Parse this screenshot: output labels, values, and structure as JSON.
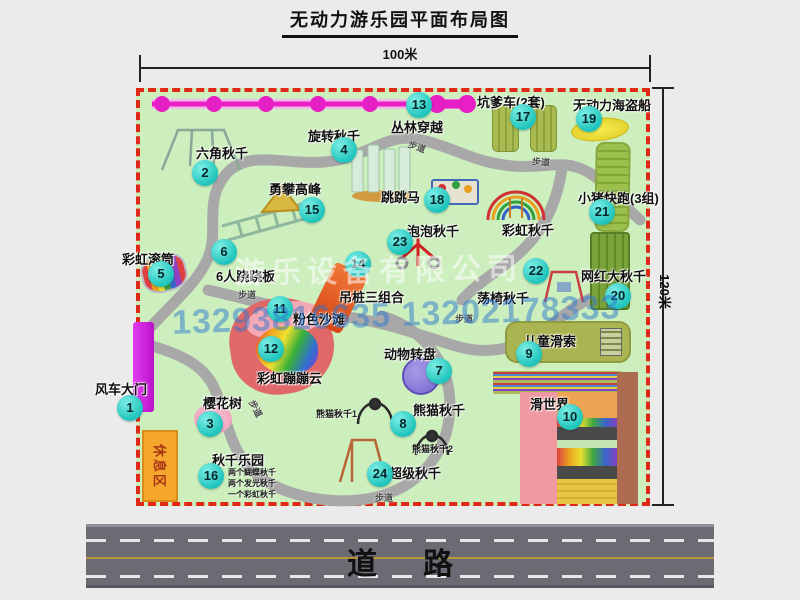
{
  "title": "无动力游乐园平面布局图",
  "dimensions": {
    "width": "100米",
    "height": "120米"
  },
  "road_label": "道路",
  "watermark": {
    "company": "游乐设备有限公司",
    "phones": "13293816635 13202178333"
  },
  "rest_area_label": "休息区",
  "path_label": "步道",
  "attractions": [
    {
      "num": "1",
      "name": "风车大门"
    },
    {
      "num": "2",
      "name": "六角秋千"
    },
    {
      "num": "3",
      "name": "樱花树"
    },
    {
      "num": "4",
      "name": "旋转秋千"
    },
    {
      "num": "5",
      "name": "彩虹滚筒"
    },
    {
      "num": "6",
      "name": "6人跷跷板"
    },
    {
      "num": "7",
      "name": "动物转盘"
    },
    {
      "num": "8",
      "name": "熊猫秋千"
    },
    {
      "num": "9",
      "name": "儿童滑索"
    },
    {
      "num": "10",
      "name": "滑世界"
    },
    {
      "num": "11",
      "name": "粉色沙滩"
    },
    {
      "num": "12",
      "name": "彩虹蹦蹦云"
    },
    {
      "num": "13",
      "name": "丛林穿越"
    },
    {
      "num": "14",
      "name": "吊桩三组合"
    },
    {
      "num": "15",
      "name": "勇攀高峰"
    },
    {
      "num": "16",
      "name": "秋千乐园"
    },
    {
      "num": "17",
      "name": "坑爹车(2套)"
    },
    {
      "num": "18",
      "name": "跳跳马"
    },
    {
      "num": "19",
      "name": "无动力海盗船"
    },
    {
      "num": "20",
      "name": "网红大秋千"
    },
    {
      "num": "21",
      "name": "小猪快跑(3组)"
    },
    {
      "num": "22",
      "name": "荡椅秋千"
    },
    {
      "num": "23",
      "name": "泡泡秋千"
    },
    {
      "num": "24",
      "name": "超级秋千"
    }
  ],
  "extra_labels": {
    "rainbow_swing": "彩虹秋千"
  },
  "sub_labels": {
    "panda1": "熊猫秋千1",
    "panda2": "熊猫秋千2",
    "swing_items": [
      "两个蝴蝶秋千",
      "两个发光秋千",
      "一个彩虹秋千"
    ]
  },
  "colors": {
    "park_fill": "#cdeebd",
    "border_red": "#e02818",
    "badge_cyan": "#1fc4bc",
    "path_gray": "#a8a8a8",
    "zipline_magenta": "#e71fc4",
    "gate_magenta": "#cf22dd",
    "rest_area_orange": "#f5a62d",
    "road_gray": "#6b6b73",
    "road_center_yellow": "#b89838",
    "watermark_blue": "#2c78cd"
  }
}
